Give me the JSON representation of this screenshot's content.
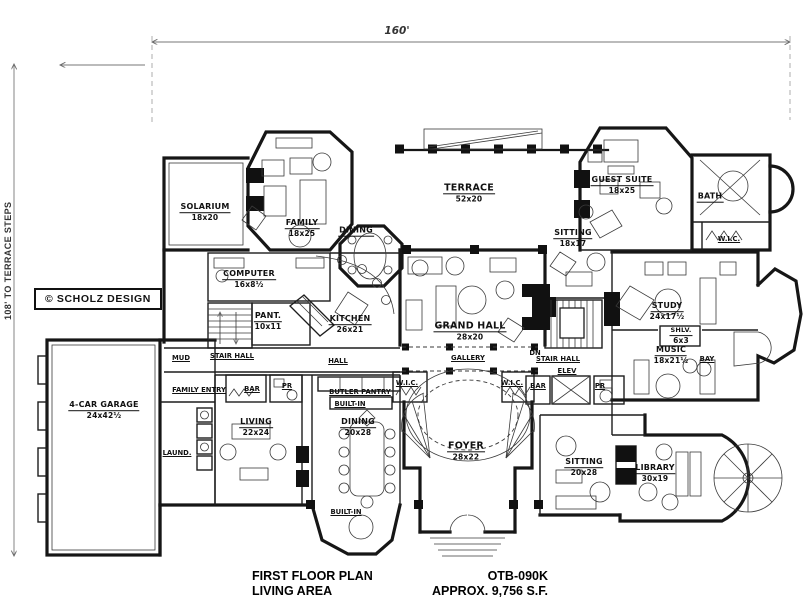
{
  "drawing": {
    "dimensions": {
      "width": "160'",
      "height": "108' TO TERRACE STEPS"
    },
    "copyright": "© SCHOLZ DESIGN",
    "caption": {
      "title": "FIRST FLOOR PLAN",
      "plan_number": "OTB-090K",
      "area_label": "LIVING AREA",
      "area_value": "APPROX. 9,756 S.F."
    },
    "rooms": [
      {
        "name": "SOLARIUM",
        "size": "18x20"
      },
      {
        "name": "FAMILY",
        "size": "18x25"
      },
      {
        "name": "DINING",
        "size": ""
      },
      {
        "name": "TERRACE",
        "size": "52x20"
      },
      {
        "name": "GUEST SUITE",
        "size": "18x25"
      },
      {
        "name": "BATH",
        "size": ""
      },
      {
        "name": "SITTING",
        "size": "18x17"
      },
      {
        "name": "COMPUTER",
        "size": "16x8½"
      },
      {
        "name": "PANT.",
        "size": "10x11"
      },
      {
        "name": "KITCHEN",
        "size": "26x21"
      },
      {
        "name": "GRAND HALL",
        "size": "28x20"
      },
      {
        "name": "STUDY",
        "size": "24x17½"
      },
      {
        "name": "SHLV.",
        "size": "6x3"
      },
      {
        "name": "MUSIC",
        "size": "18x21½"
      },
      {
        "name": "4-CAR GARAGE",
        "size": "24x42½"
      },
      {
        "name": "LIVING",
        "size": "22x24"
      },
      {
        "name": "DINING",
        "size": "20x28"
      },
      {
        "name": "FOYER",
        "size": "28x22"
      },
      {
        "name": "SITTING",
        "size": "20x28"
      },
      {
        "name": "LIBRARY",
        "size": "30x19"
      }
    ],
    "labels": [
      "W.I.C.",
      "MUD",
      "STAIR HALL",
      "HALL",
      "GALLERY",
      "STAIR HALL",
      "DN",
      "ELEV",
      "BAY",
      "FAMILY ENTRY",
      "LAUND.",
      "BAR",
      "PR",
      "BUTLER PANTRY",
      "BUILT-IN",
      "W.I.C.",
      "W.I.C.",
      "BAR",
      "PR",
      "BUILT-IN"
    ]
  }
}
